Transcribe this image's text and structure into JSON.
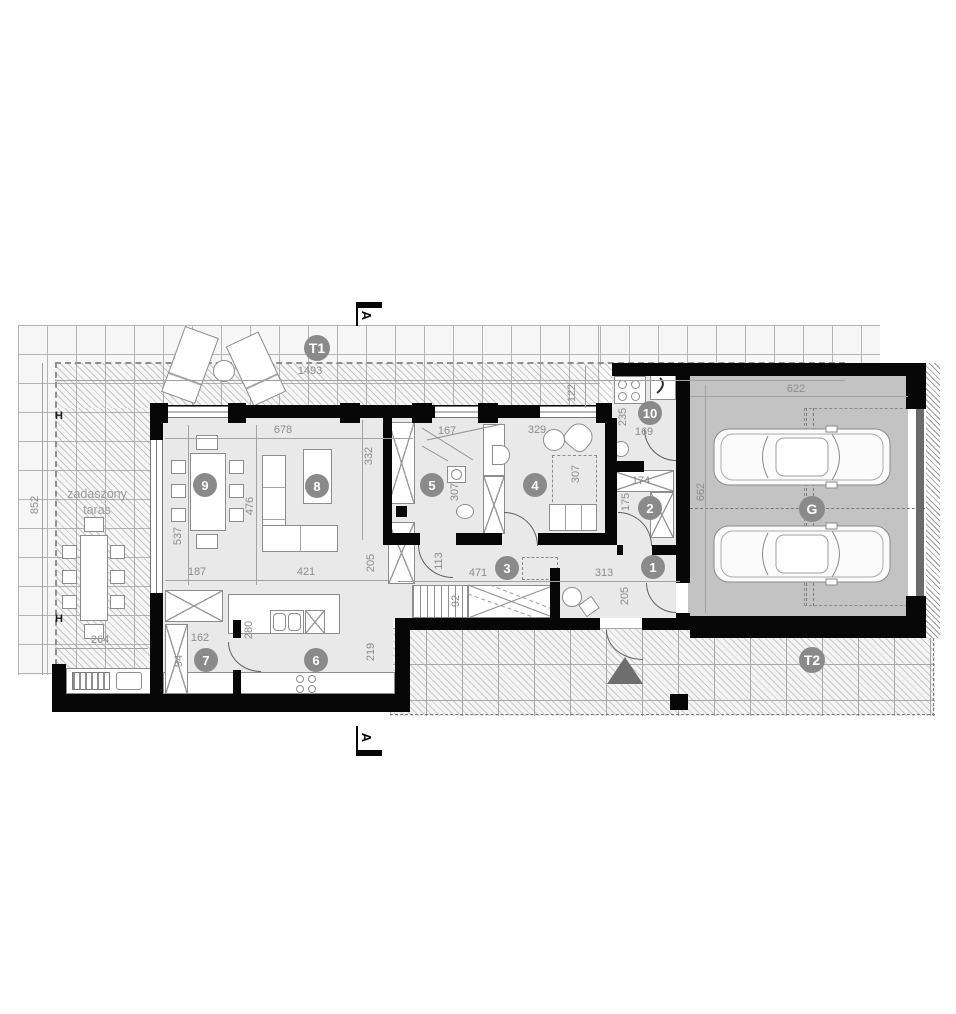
{
  "plan": {
    "section_marker_top": "A",
    "section_marker_bottom": "A",
    "terrace_label_line1": "zadaszony",
    "terrace_label_line2": "taras",
    "h_marker_top": "H",
    "h_marker_bottom": "H",
    "badges": [
      {
        "id": "T1",
        "label": "T1"
      },
      {
        "id": "T2",
        "label": "T2"
      },
      {
        "id": "G",
        "label": "G"
      },
      {
        "id": "r1",
        "label": "1"
      },
      {
        "id": "r2",
        "label": "2"
      },
      {
        "id": "r3",
        "label": "3"
      },
      {
        "id": "r4",
        "label": "4"
      },
      {
        "id": "r5",
        "label": "5"
      },
      {
        "id": "r6",
        "label": "6"
      },
      {
        "id": "r7",
        "label": "7"
      },
      {
        "id": "r8",
        "label": "8"
      },
      {
        "id": "r9",
        "label": "9"
      },
      {
        "id": "r10",
        "label": "10"
      }
    ],
    "dimensions": [
      {
        "id": "d1",
        "value": "1493"
      },
      {
        "id": "d2",
        "value": "122"
      },
      {
        "id": "d3",
        "value": "852"
      },
      {
        "id": "d4",
        "value": "678"
      },
      {
        "id": "d5",
        "value": "167"
      },
      {
        "id": "d6",
        "value": "329"
      },
      {
        "id": "d7",
        "value": "235"
      },
      {
        "id": "d8",
        "value": "169"
      },
      {
        "id": "d9",
        "value": "622"
      },
      {
        "id": "d10",
        "value": "662"
      },
      {
        "id": "d11",
        "value": "332"
      },
      {
        "id": "d12",
        "value": "537"
      },
      {
        "id": "d13",
        "value": "476"
      },
      {
        "id": "d14",
        "value": "307"
      },
      {
        "id": "d15",
        "value": "307"
      },
      {
        "id": "d16",
        "value": "174"
      },
      {
        "id": "d17",
        "value": "175"
      },
      {
        "id": "d18",
        "value": "187"
      },
      {
        "id": "d19",
        "value": "421"
      },
      {
        "id": "d20",
        "value": "205"
      },
      {
        "id": "d21",
        "value": "113"
      },
      {
        "id": "d22",
        "value": "471"
      },
      {
        "id": "d23",
        "value": "313"
      },
      {
        "id": "d24",
        "value": "205"
      },
      {
        "id": "d25",
        "value": "92"
      },
      {
        "id": "d26",
        "value": "264"
      },
      {
        "id": "d27",
        "value": "162"
      },
      {
        "id": "d28",
        "value": "94"
      },
      {
        "id": "d29",
        "value": "280"
      },
      {
        "id": "d30",
        "value": "219"
      }
    ],
    "colors": {
      "wall": "#070707",
      "room_floor": "#e9e9e9",
      "garage_floor": "#c3c3c3",
      "badge": "#8a8a8a",
      "dimension_text": "#8c8c8c",
      "entry_arrow": "#6e6e6e"
    }
  }
}
